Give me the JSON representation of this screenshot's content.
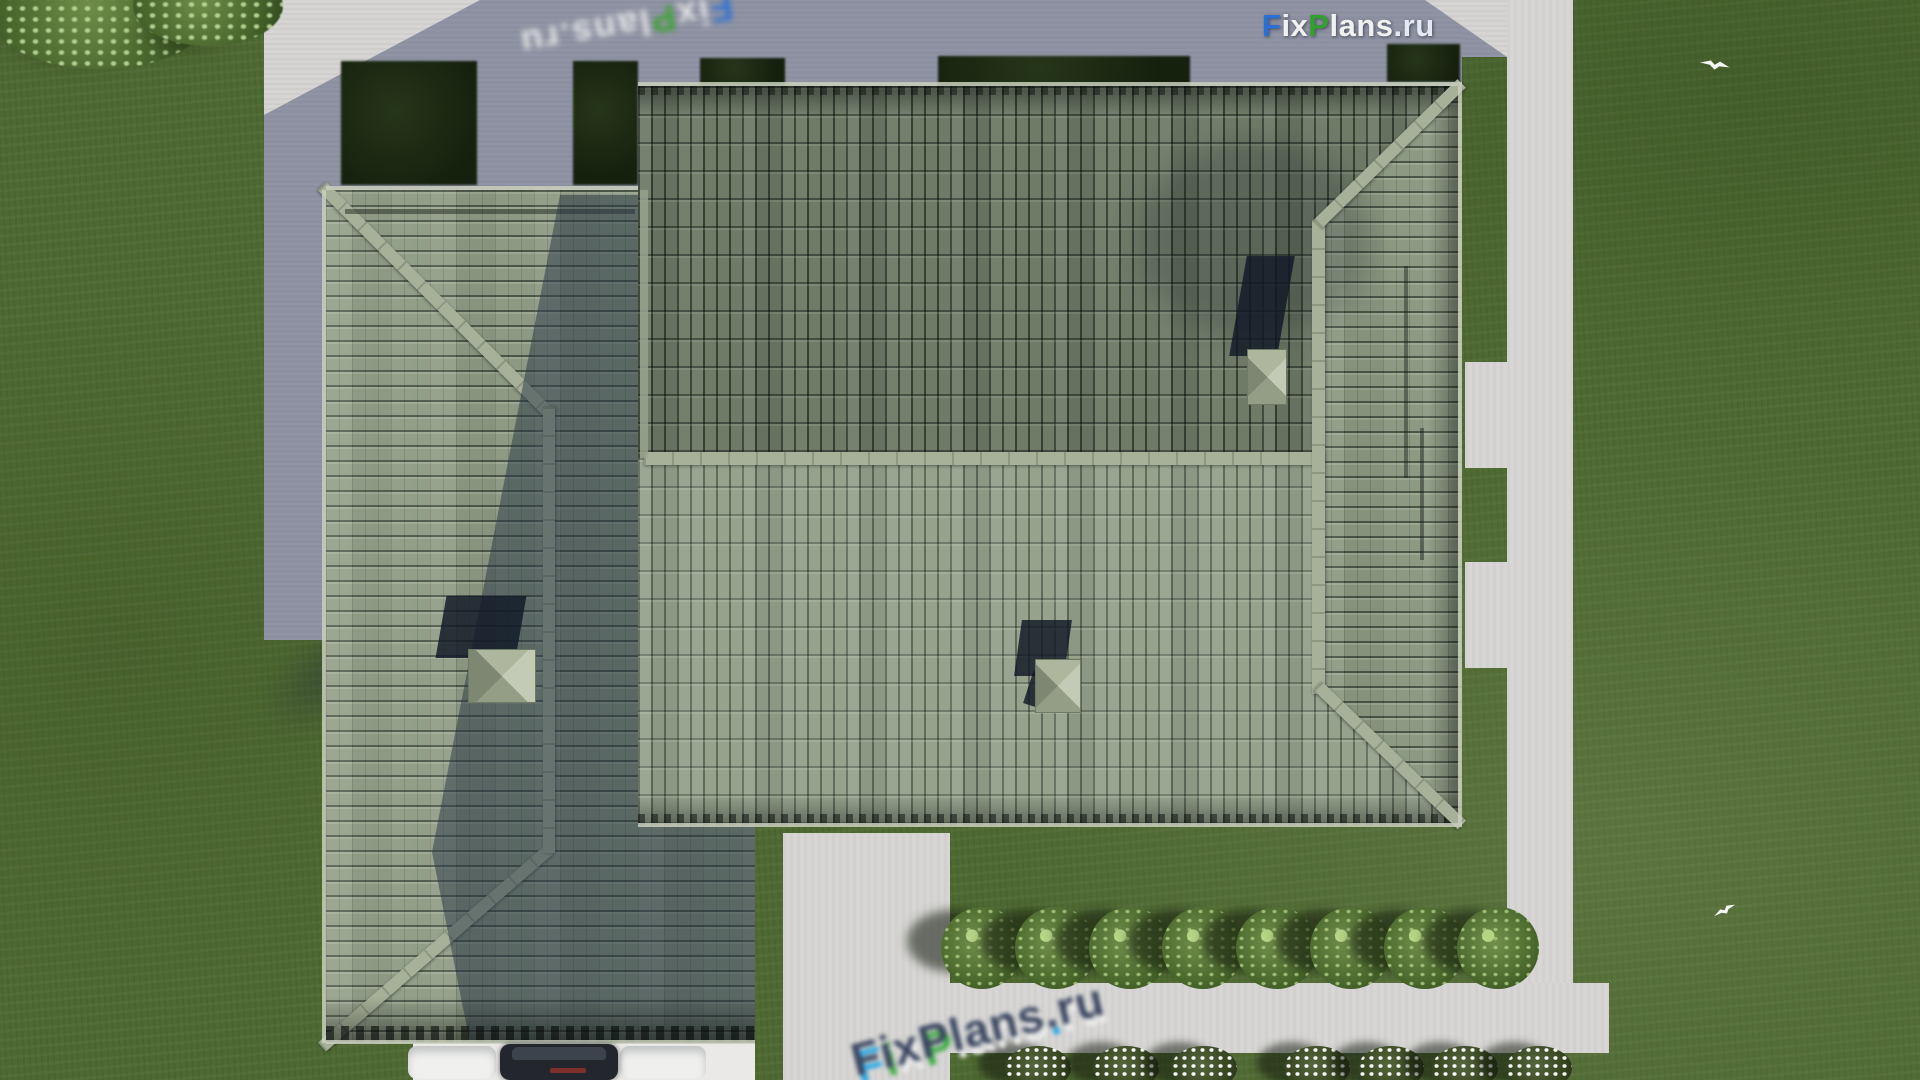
{
  "branding": {
    "logo": {
      "part_f": "F",
      "part_ix": "ix",
      "part_p": "P",
      "part_lans": "lans",
      "part_dotru": ".ru",
      "blue": "#2a6fd6",
      "green": "#31a02e",
      "white": "#f1f1f1"
    },
    "watermark_text": "FixPlans.ru",
    "watermark_letters": [
      {
        "ch": "F",
        "main": "#3a4660",
        "refl": "#29a8e6"
      },
      {
        "ch": "i",
        "main": "#3a4660",
        "refl": "#3fae46"
      },
      {
        "ch": "x",
        "main": "#3a4660",
        "refl": "#ececec"
      },
      {
        "ch": "P",
        "main": "#3a4660",
        "refl": "#3fae46"
      },
      {
        "ch": "l",
        "main": "#3a4660",
        "refl": "#ececec"
      },
      {
        "ch": "a",
        "main": "#3a4660",
        "refl": "#ececec"
      },
      {
        "ch": "n",
        "main": "#3a4660",
        "refl": "#ececec"
      },
      {
        "ch": "s",
        "main": "#3a4660",
        "refl": "#ececec"
      },
      {
        "ch": ".",
        "main": "#3a4660",
        "refl": "#29a8e6"
      },
      {
        "ch": "r",
        "main": "#3a4660",
        "refl": "#ececec"
      },
      {
        "ch": "u",
        "main": "#3a4660",
        "refl": "#ececec"
      }
    ]
  },
  "scene": {
    "type": "aerial-3d-render",
    "subject": "Top-down aerial render of a hip-roofed house with sage-green tiled roof, concrete pad, garden paths, lawn, bushes and parked car",
    "colors": {
      "grass": "#4e6931",
      "pad_shadow": "#8c90a1",
      "pad_sunlit": "#d6d5d3",
      "path": "#d7d6d4",
      "roof_north_slope": "#6f7b67",
      "roof_south_slope": "#96a28c",
      "roof_east_wing": "#8d9a83",
      "ridge_cap": "#a7b098",
      "cast_shadow_blue": "#2a3950",
      "hedge_dark": "#1b2712",
      "bush_green": "#4c6a2e",
      "flower_bush_white": "#f4f6f0",
      "apron_white": "#ebe9e7",
      "car_dark": "#23262c"
    },
    "landscaping": {
      "round_bushes": [
        {
          "x": 982,
          "y": 948
        },
        {
          "x": 1056,
          "y": 948
        },
        {
          "x": 1130,
          "y": 948
        },
        {
          "x": 1203,
          "y": 948
        },
        {
          "x": 1277,
          "y": 948
        },
        {
          "x": 1351,
          "y": 948
        },
        {
          "x": 1425,
          "y": 948
        },
        {
          "x": 1498,
          "y": 948
        }
      ],
      "flower_bushes": [
        {
          "x": 1038,
          "y": 1066
        },
        {
          "x": 1126,
          "y": 1066
        },
        {
          "x": 1204,
          "y": 1066
        },
        {
          "x": 1317,
          "y": 1066
        },
        {
          "x": 1391,
          "y": 1066
        },
        {
          "x": 1465,
          "y": 1066
        },
        {
          "x": 1539,
          "y": 1066
        }
      ],
      "hedges": [
        {
          "x": 341,
          "y": 61,
          "w": 136,
          "h": 124
        },
        {
          "x": 573,
          "y": 61,
          "w": 65,
          "h": 124
        },
        {
          "x": 700,
          "y": 58,
          "w": 85,
          "h": 27
        },
        {
          "x": 938,
          "y": 56,
          "w": 252,
          "h": 30
        },
        {
          "x": 1387,
          "y": 44,
          "w": 73,
          "h": 38
        }
      ],
      "corner_bushes": [
        {
          "x": 100,
          "y": 14,
          "w": 220,
          "h": 110
        },
        {
          "x": 208,
          "y": 6,
          "w": 150,
          "h": 80
        }
      ],
      "birds": [
        {
          "x": 1700,
          "y": 52,
          "w": 30,
          "h": 22,
          "r": 10
        },
        {
          "x": 1712,
          "y": 900,
          "w": 24,
          "h": 18,
          "r": -28
        }
      ]
    }
  }
}
